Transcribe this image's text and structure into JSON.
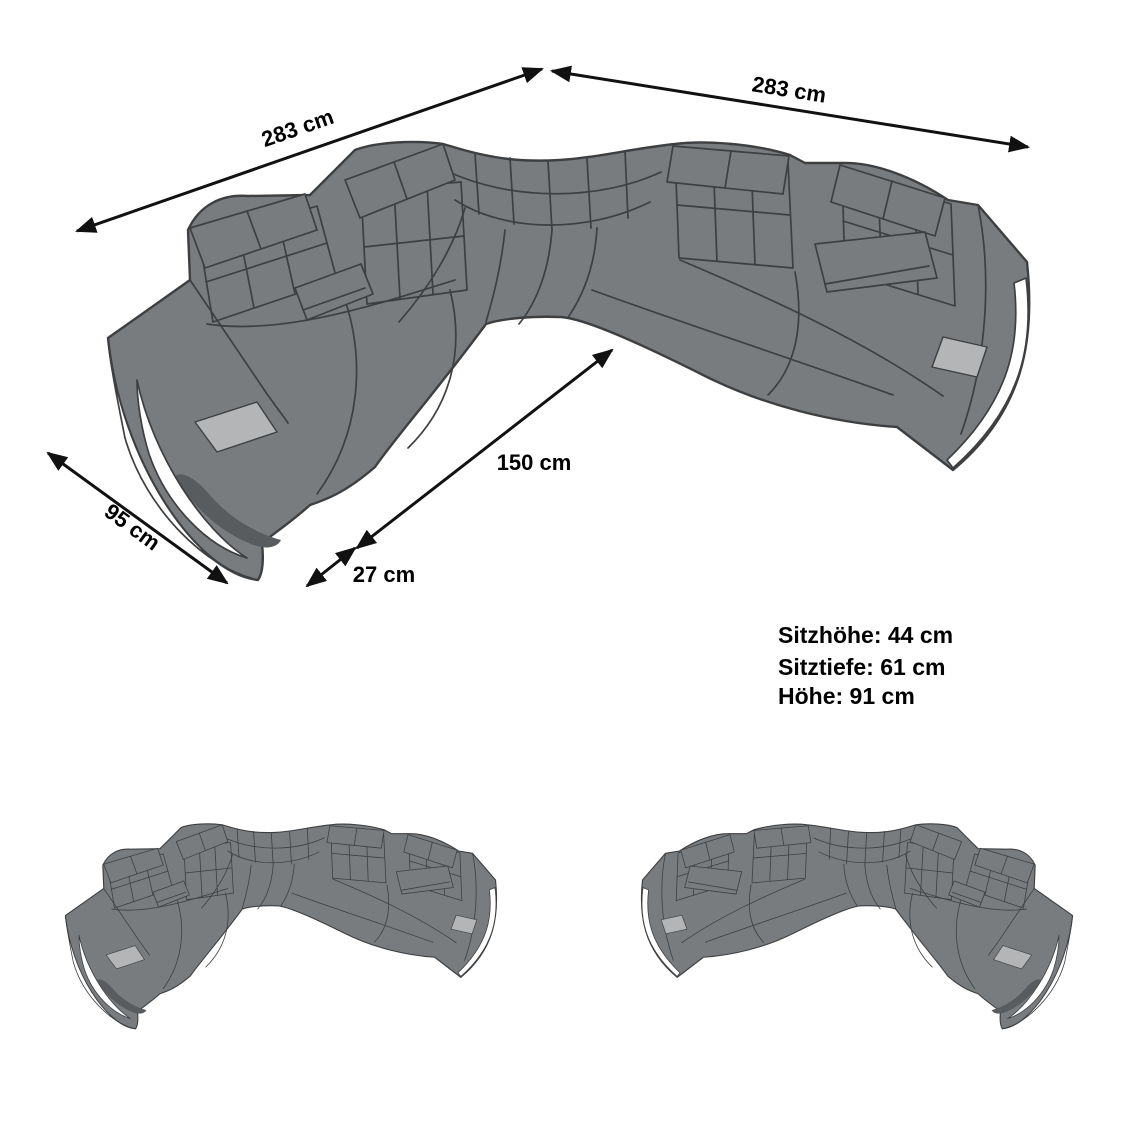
{
  "diagram": {
    "dimension_labels": {
      "back_left": "283 cm",
      "back_right": "283 cm",
      "seat_front": "150 cm",
      "arm_front": "27 cm",
      "side_depth": "95 cm"
    },
    "spec_lines": [
      "Sitzhöhe: 44 cm",
      "Sitztiefe: 61 cm",
      "Höhe: 91 cm"
    ],
    "colors": {
      "sofa-gray": "#797c7e",
      "sofa-outline": "#3d3f41",
      "pad-gray": "#b3b5b7",
      "shadow-gray": "#595c5e",
      "accent-white": "#ffffff",
      "annotation": "#111111"
    }
  }
}
